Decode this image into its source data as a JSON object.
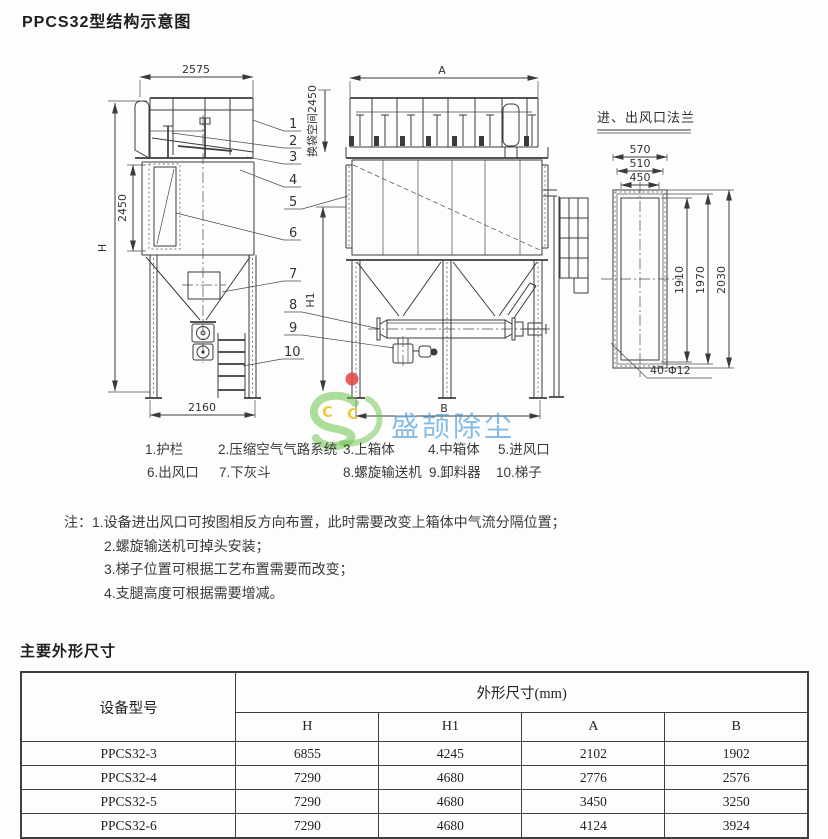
{
  "page": {
    "title": "PPCS32型结构示意图"
  },
  "drawing": {
    "front_view": {
      "dim_width_top": "2575",
      "dim_height_overall": "H",
      "dim_height_upper": "2450",
      "dim_width_bottom": "2160"
    },
    "side_view": {
      "dim_width_top": "A",
      "dim_space_label": "换袋空间2450",
      "dim_height": "H1",
      "dim_width_bottom": "B"
    },
    "flange_view": {
      "title": "进、出风口法兰",
      "dim_w1": "570",
      "dim_w2": "510",
      "dim_w3": "450",
      "dim_h1": "1910",
      "dim_h2": "1970",
      "dim_h3": "2030",
      "bolt_note": "40-Φ12"
    },
    "callouts": [
      "1",
      "2",
      "3",
      "4",
      "5",
      "6",
      "7",
      "8",
      "9",
      "10"
    ]
  },
  "watermark": {
    "logo_letters": [
      "C",
      "C"
    ],
    "brand_text": "盛颉除尘",
    "green": "#6cc24a",
    "blue": "#57a3dc",
    "red": "#e04343",
    "yellow": "#edc72e"
  },
  "legend": {
    "rows": [
      [
        "1.护栏",
        "2.压缩空气气路系统",
        "3.上箱体",
        "4.中箱体",
        "5.进风口"
      ],
      [
        "6.出风口",
        "7.下灰斗",
        "8.螺旋输送机",
        "9.卸料器",
        "10.梯子"
      ]
    ]
  },
  "notes": {
    "prefix": "注：",
    "items": [
      "1.设备进出风口可按图相反方向布置，此时需要改变上箱体中气流分隔位置；",
      "2.螺旋输送机可掉头安装；",
      "3.梯子位置可根据工艺布置需要而改变；",
      "4.支腿高度可根据需要增减。"
    ]
  },
  "dimensions_section": {
    "title": "主要外形尺寸",
    "table": {
      "model_header": "设备型号",
      "group_header": "外形尺寸(mm)",
      "sub_headers": [
        "H",
        "H1",
        "A",
        "B"
      ],
      "rows": [
        [
          "PPCS32-3",
          "6855",
          "4245",
          "2102",
          "1902"
        ],
        [
          "PPCS32-4",
          "7290",
          "4680",
          "2776",
          "2576"
        ],
        [
          "PPCS32-5",
          "7290",
          "4680",
          "3450",
          "3250"
        ],
        [
          "PPCS32-6",
          "7290",
          "4680",
          "4124",
          "3924"
        ]
      ]
    }
  }
}
